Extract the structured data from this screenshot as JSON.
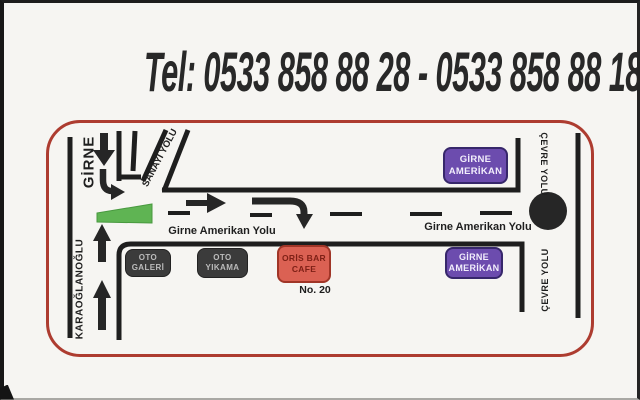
{
  "header": {
    "tel": "Tel: 0533 858 88 28 - 0533 858 88 18"
  },
  "map": {
    "road_labels": {
      "girne": "GİRNE",
      "karaoglanoglu": "KARAOĞLANOĞLU",
      "sanayi_yolu": "SANAYİ YOLU",
      "girne_amerikan_yolu_left": "Girne Amerikan Yolu",
      "girne_amerikan_yolu_right": "Girne Amerikan Yolu",
      "cevre_yolu_top": "ÇEVRE YOLU",
      "cevre_yolu_bottom": "ÇEVRE YOLU"
    },
    "places": {
      "oto_galeri_line1": "OTO",
      "oto_galeri_line2": "GALERİ",
      "oto_yikama_line1": "OTO",
      "oto_yikama_line2": "YIKAMA",
      "oris_bar_line1": "ORİS BAR",
      "oris_bar_line2": "CAFE",
      "address_no": "No. 20",
      "girne_amerikan_top_line1": "GİRNE",
      "girne_amerikan_top_line2": "AMERİKAN",
      "girne_amerikan_bottom_line1": "GİRNE",
      "girne_amerikan_bottom_line2": "AMERİKAN"
    },
    "colors": {
      "map_border": "#ad3c30",
      "purple_box": "#6c4cae",
      "salmon_box": "#db6153",
      "salmon_text": "#7e2016",
      "dark_box": "#3b3b3b",
      "dark_box_text": "#bcbcbc",
      "green_median": "#5fb453",
      "road": "#1e1e1e"
    }
  }
}
